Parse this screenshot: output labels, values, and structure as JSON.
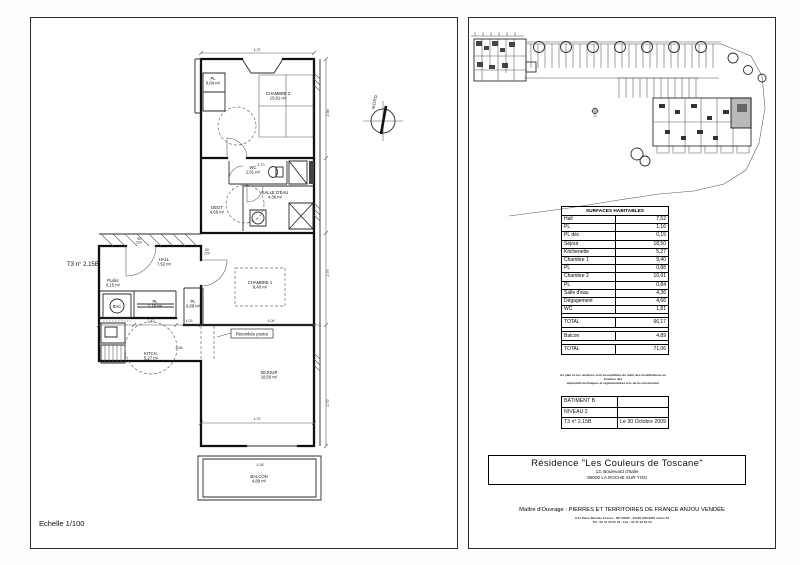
{
  "document": {
    "scale_label": "Echelle 1/100",
    "unit_label": "T3 n° 2.15B",
    "north_label": "NORD"
  },
  "floorplan": {
    "callout": "Retombée poutre",
    "rooms": [
      {
        "name": "CHAMBRE 2",
        "area": "10,91 m²",
        "x": 247,
        "y": 77
      },
      {
        "name": "PL",
        "area": "0,84 m²",
        "x": 182,
        "y": 62,
        "s": 3.4
      },
      {
        "name": "WC",
        "area": "1,81 m²",
        "x": 222,
        "y": 151,
        "s": 3.2
      },
      {
        "name": "SALLE D'EAU",
        "area": "4,36 m²",
        "x": 244,
        "y": 176,
        "s": 3.3
      },
      {
        "name": "DEGT",
        "area": "4,66 m²",
        "x": 186,
        "y": 191,
        "s": 3.4
      },
      {
        "name": "HALL",
        "area": "7,52 m²",
        "x": 133,
        "y": 243
      },
      {
        "name": "PLdéc",
        "area": "0,15 m²",
        "x": 82,
        "y": 264,
        "s": 3
      },
      {
        "name": "BAC",
        "area": "",
        "x": 86,
        "y": 290,
        "s": 3.2
      },
      {
        "name": "PL",
        "area": "1,16 m²",
        "x": 124,
        "y": 285,
        "s": 3.4
      },
      {
        "name": "CHAMBRE 1",
        "area": "9,40 m²",
        "x": 229,
        "y": 266
      },
      {
        "name": "PL",
        "area": "0,88 m²",
        "x": 162,
        "y": 285,
        "s": 3
      },
      {
        "name": "KITCH.",
        "area": "5,27 m²",
        "x": 120,
        "y": 337
      },
      {
        "name": "SEJOUR",
        "area": "18,50 m²",
        "x": 238,
        "y": 356
      },
      {
        "name": "BALCON",
        "area": "4,89 m²",
        "x": 228,
        "y": 460
      }
    ],
    "dimensions": [
      {
        "t": "4,70",
        "x": 226,
        "y": 33
      },
      {
        "t": "4,70",
        "x": 230,
        "y": 148
      },
      {
        "t": "2,43",
        "x": 120,
        "y": 304
      },
      {
        "t": "1,03",
        "x": 158,
        "y": 304
      },
      {
        "t": "4,06",
        "x": 240,
        "y": 304
      },
      {
        "t": "4,70",
        "x": 226,
        "y": 402
      },
      {
        "t": "4,38",
        "x": 229,
        "y": 448
      },
      {
        "t": "2,88",
        "x": 148,
        "y": 331
      },
      {
        "t": "2,98",
        "x": 298,
        "y": 95,
        "r": -90
      },
      {
        "t": "2,79",
        "x": 298,
        "y": 255,
        "r": -90
      },
      {
        "t": "2,70",
        "x": 298,
        "y": 385,
        "r": -90
      },
      {
        "t": "90",
        "x": 108,
        "y": 222,
        "s": 2.8
      },
      {
        "t": "220",
        "x": 108,
        "y": 225.5,
        "s": 2.8
      },
      {
        "t": "80",
        "x": 176,
        "y": 233,
        "s": 2.8
      },
      {
        "t": "220",
        "x": 176,
        "y": 236.5,
        "s": 2.8
      }
    ]
  },
  "surfaces": {
    "title": "SURFACES HABITABLES",
    "rows": [
      {
        "label": "Hall",
        "value": "7,52"
      },
      {
        "label": "PL",
        "value": "1,16"
      },
      {
        "label": "PL déc",
        "value": "0,15"
      },
      {
        "label": "Séjour",
        "value": "18,50"
      },
      {
        "label": "Kitchenette",
        "value": "5,27"
      },
      {
        "label": "Chambre 1",
        "value": "9,40"
      },
      {
        "label": "PL",
        "value": "0,88"
      },
      {
        "label": "Chambre 2",
        "value": "10,91"
      },
      {
        "label": "PL",
        "value": "0,84"
      },
      {
        "label": "Salle d'eau",
        "value": "4,36"
      },
      {
        "label": "Dégagement",
        "value": "4,66"
      },
      {
        "label": "WC",
        "value": "1,81"
      },
      {
        "type": "spacer"
      },
      {
        "label": "TOTAL",
        "value": "66,17",
        "type": "total"
      },
      {
        "type": "spacer"
      },
      {
        "label": "Balcon",
        "value": "4,89",
        "type": "total"
      },
      {
        "type": "spacer"
      },
      {
        "label": "TOTAL",
        "value": "71,06",
        "type": "total"
      }
    ]
  },
  "notes": {
    "line1": "Ce plan et ces surfaces sont susceptibles de subir des modifications en fonction des",
    "line2": "impératifs techniques et réglementaires lors de la construction"
  },
  "cartouche": {
    "batiment": "BÂTIMENT B",
    "niveau": "NIVEAU 2",
    "unit": "T3 n° 2.15B",
    "date": "Le 30 Octobre 2009"
  },
  "title_block": {
    "residence": "Résidence \"Les Couleurs de Toscane\"",
    "address1": "13, Boulevard d'Italie",
    "address2": "85000 LA ROCHE SUR YON"
  },
  "owner": {
    "label": "Maître d'Ouvrage : PIERRES ET TERRITOIRES DE FRANCE ANJOU VENDÉE",
    "address": "9-11 Place Mendès France - BP 20535 - 49105 ANGERS cedex 02",
    "phone": "Tél : 02 41 23 52 52 - Fax : 02 41 23 52 50"
  }
}
